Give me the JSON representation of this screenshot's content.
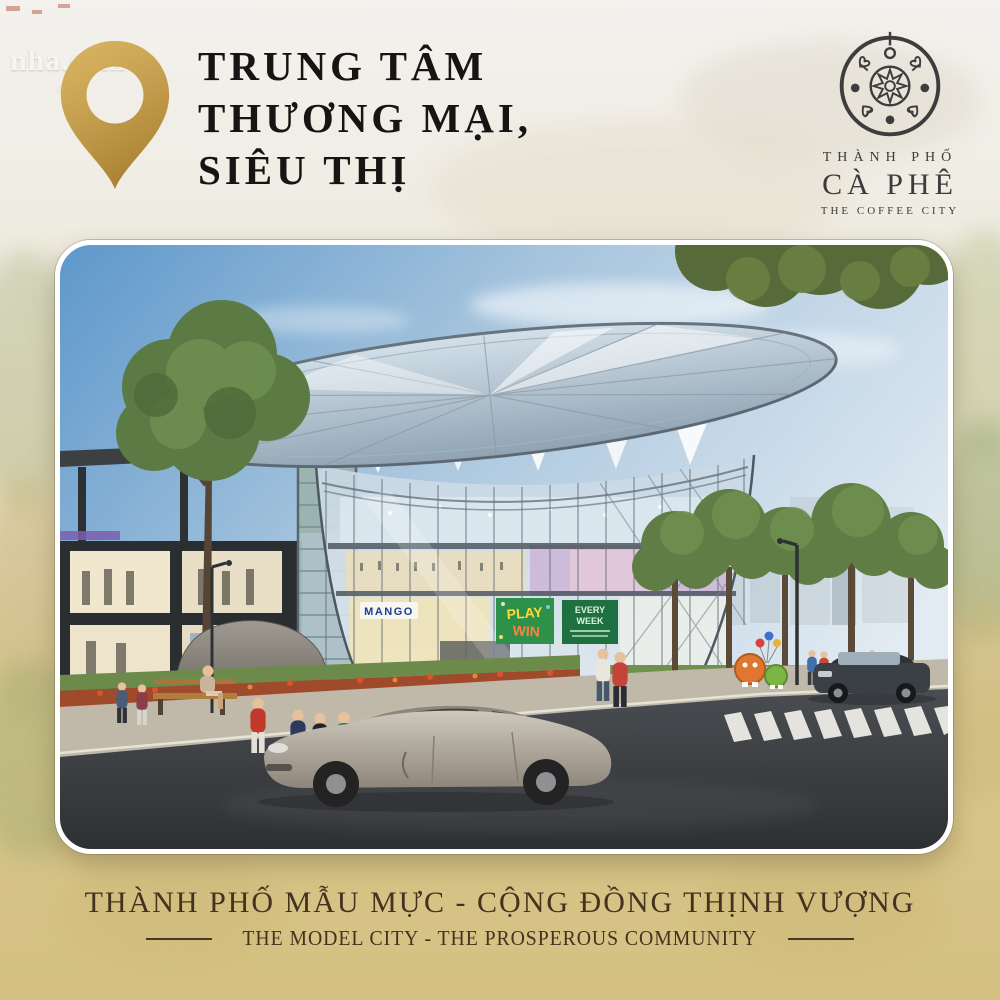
{
  "watermark": {
    "text": "nha.com",
    "subtext": "Gre"
  },
  "title": {
    "lines": [
      "TRUNG TÂM",
      "THƯƠNG MẠI,",
      "SIÊU THỊ"
    ]
  },
  "logo": {
    "top": "THÀNH PHỐ",
    "main": "CÀ PHÊ",
    "sub": "THE COFFEE CITY"
  },
  "scene": {
    "mango_sign": "MANGO",
    "play_sign": {
      "line1": "PLAY",
      "line2": "WIN"
    },
    "promo_board": {
      "line1": "EVERY",
      "line2": "WEEK"
    }
  },
  "footer": {
    "tagline_vi": "THÀNH PHỐ MẪU MỰC - CỘNG ĐỒNG THỊNH VƯỢNG",
    "tagline_en": "THE MODEL CITY - THE PROSPEROUS COMMUNITY"
  },
  "colors": {
    "gold_pin": "#c9a34f",
    "tan_background": "#d6c386",
    "title_text": "#171513",
    "footer_text": "#443220",
    "logo_ink": "#3b3b3b",
    "sky_blue": "#5e98cb",
    "road_asphalt": "#37383a"
  }
}
